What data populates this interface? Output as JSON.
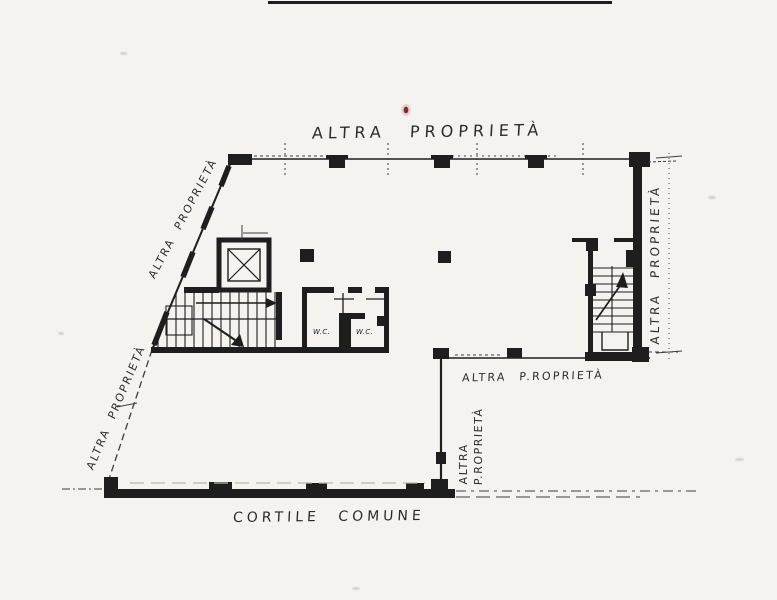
{
  "page": {
    "colors": {
      "background": "#f4f3ef",
      "ink": "#1e1e1e",
      "ink_soft": "#3c3c3c",
      "faint": "#b9b6ad",
      "red_mark": "#7d2f3a"
    }
  },
  "plan": {
    "type": "scanned cadastral floor plan",
    "labels": {
      "top_boundary": "ALTRA PROPRIETÀ",
      "upper_left_boundary": "ALTRA PROPRIETÀ",
      "lower_left_boundary": "ALTRA PROPRIETÀ",
      "right_boundary": "ALTRA PROPRIETÀ",
      "middle_right_boundary": "ALTRA P.ROPRIETÀ",
      "inner_boundary_line1": "ALTRA",
      "inner_boundary_line2": "P.ROPRIETÀ",
      "courtyard": "CORTILE COMUNE",
      "wc_left": "W.C.",
      "wc_right": "W.C."
    }
  }
}
